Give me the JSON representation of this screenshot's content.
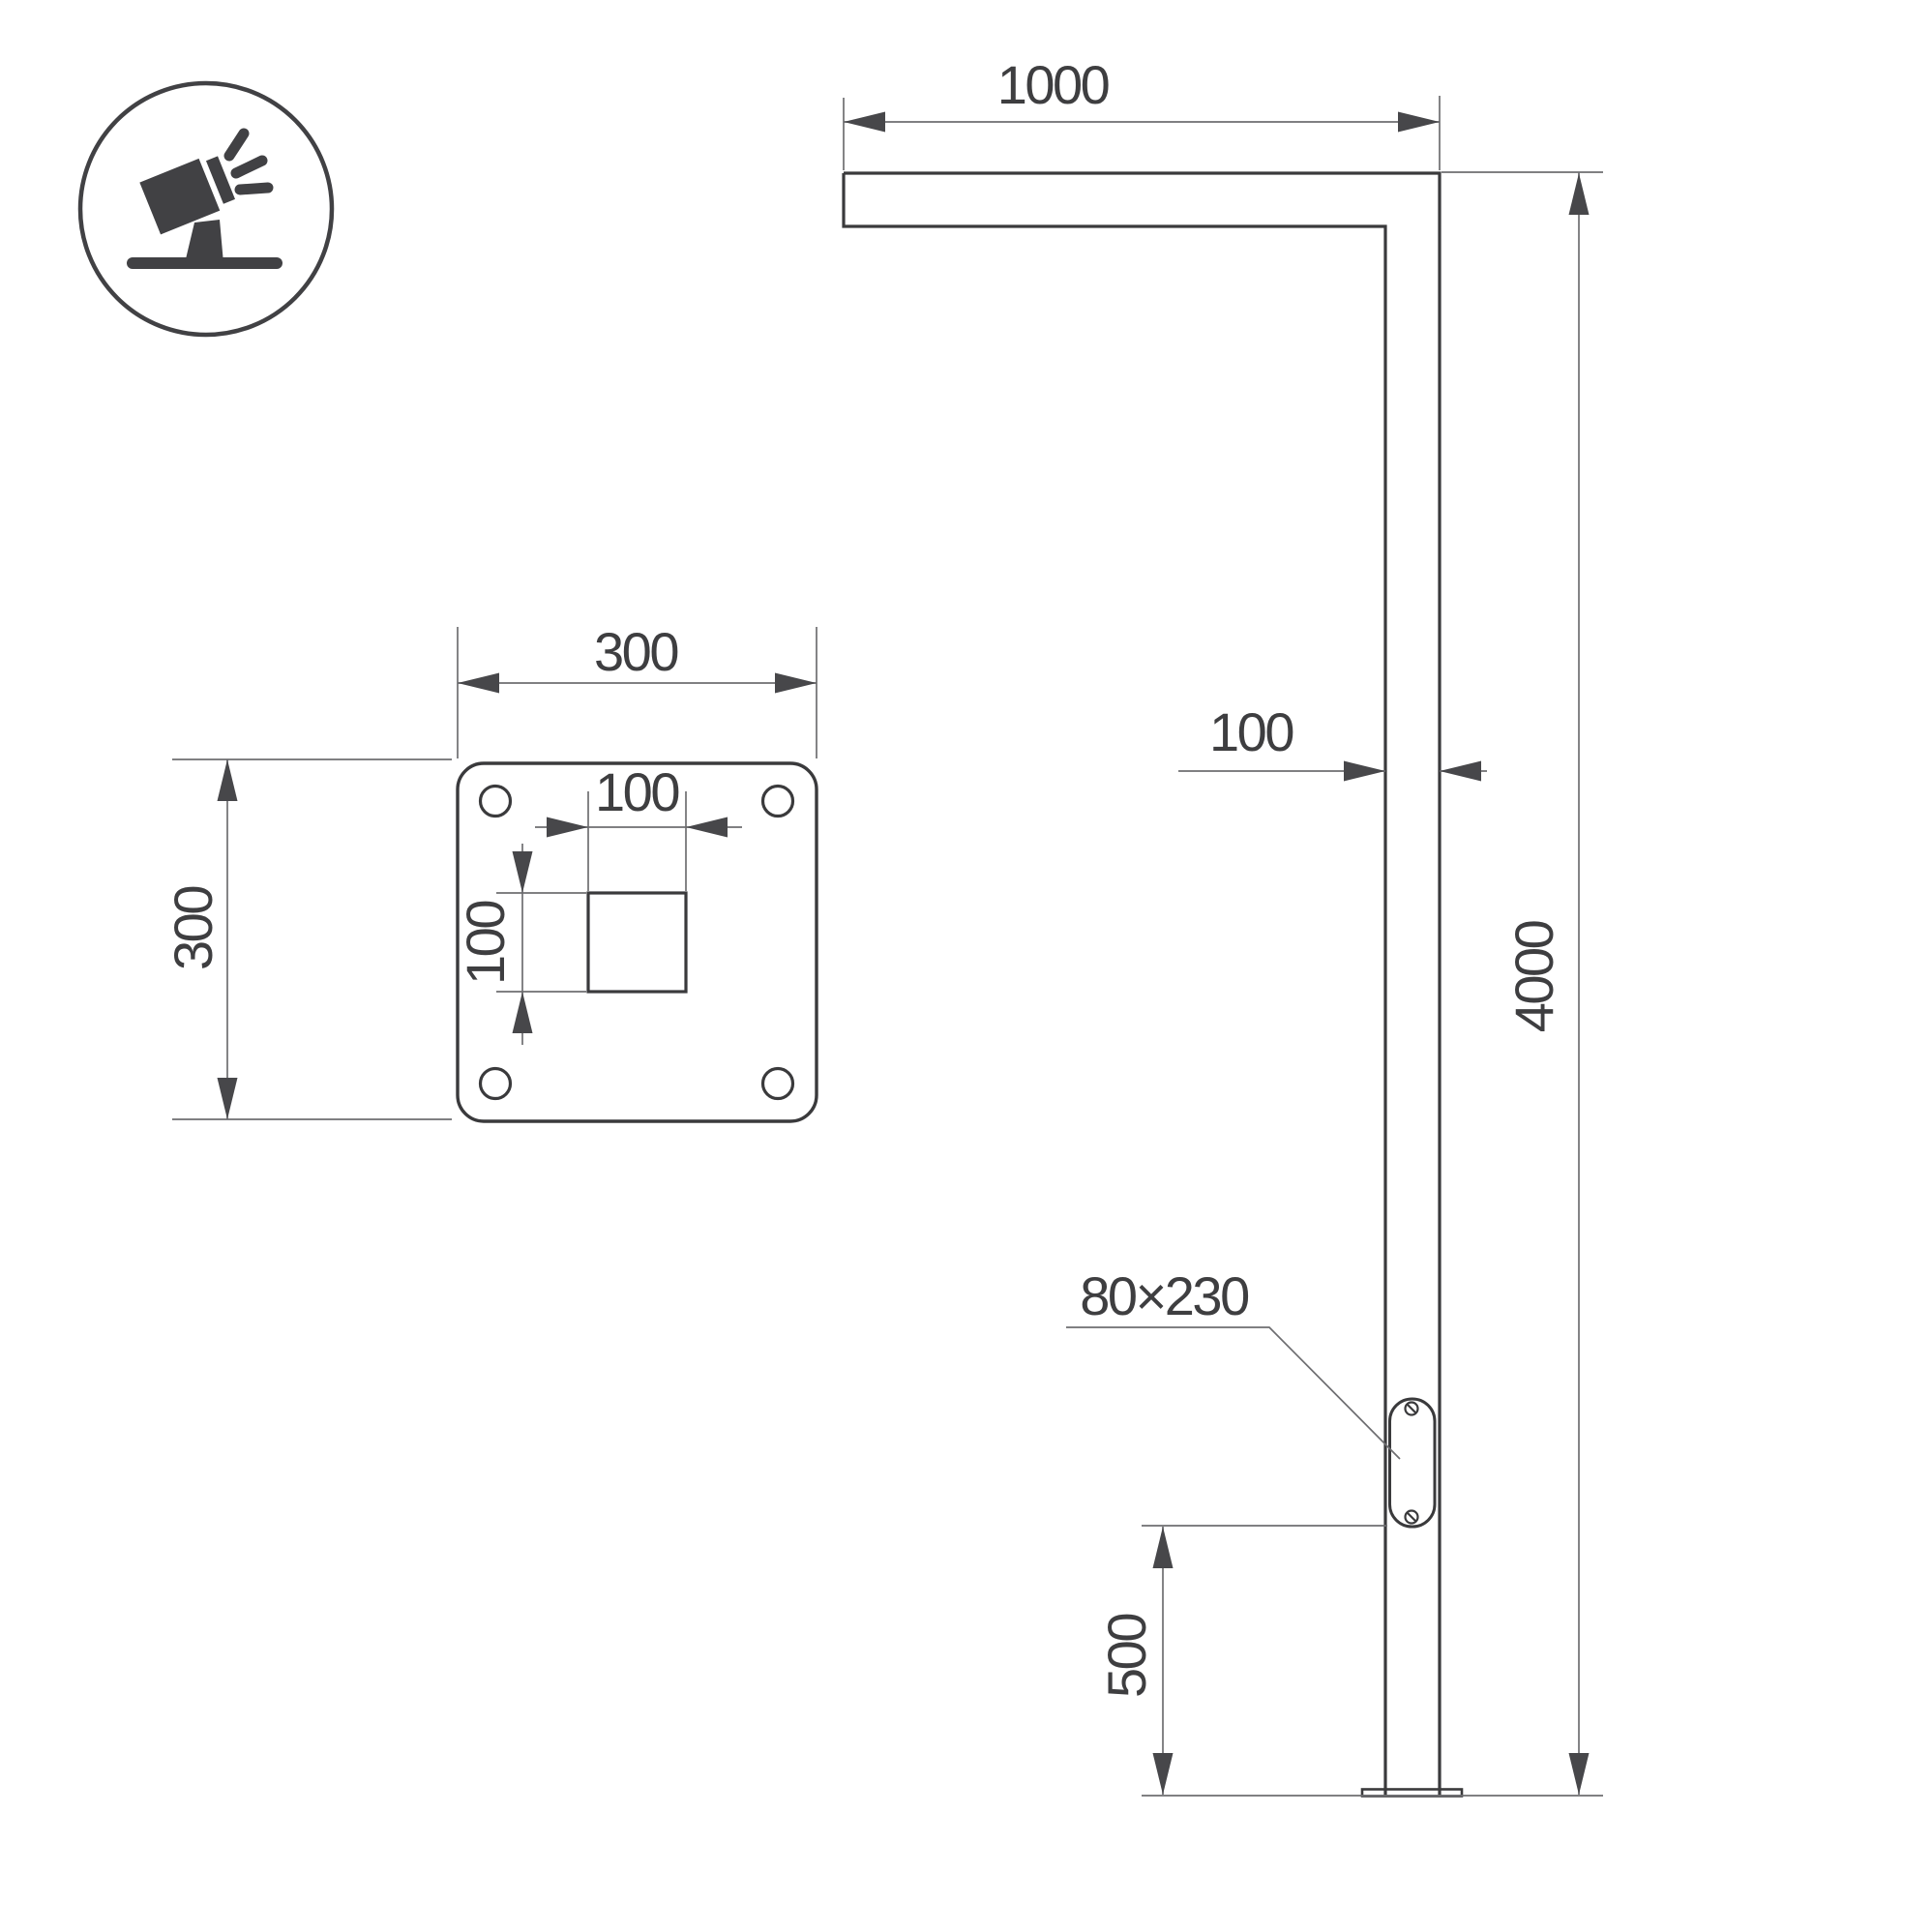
{
  "drawing": {
    "kind": "technical dimension drawing",
    "background": "#ffffff",
    "colors": {
      "outline": "#3a3a3c",
      "dimension_line": "#6e6e71",
      "arrow": "#47474a",
      "text": "#3e3e40",
      "icon": "#414144"
    },
    "icon": {
      "name": "tilted-floodlight-icon"
    },
    "elevation_view": {
      "arm_length_label": "1000",
      "pole_width_label": "100",
      "pole_height_label": "4000",
      "door_size_label": "80×230",
      "door_bottom_height_label": "500"
    },
    "plate_view": {
      "plate_width_label": "300",
      "plate_height_label": "300",
      "hole_width_label": "100",
      "hole_height_label": "100"
    }
  }
}
